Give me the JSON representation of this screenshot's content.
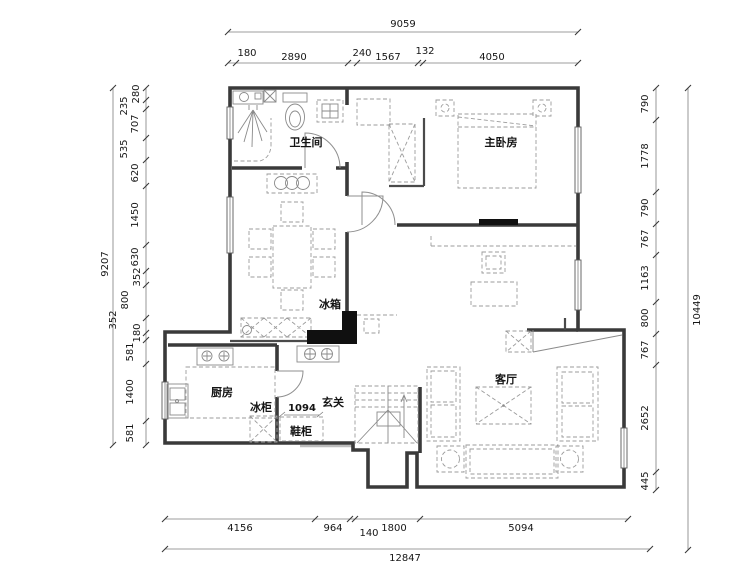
{
  "plan_type": "apartment-floor-plan",
  "rooms": {
    "bathroom": "卫生间",
    "master_bedroom": "主卧房",
    "kitchen": "厨房",
    "living_room": "客厅",
    "entrance": "玄关",
    "fridge": "冰箱",
    "freezer": "冰柜",
    "shoe_cabinet": "鞋柜"
  },
  "annotations": {
    "entry_width": "1094"
  },
  "dims": {
    "top_total": "9059",
    "top": [
      "180",
      "2890",
      "240",
      "1567",
      "132",
      "4050"
    ],
    "bottom_total": "12847",
    "bottom": [
      "4156",
      "964",
      "140",
      "1800",
      "5094"
    ],
    "left_total": "9207",
    "left": [
      "280",
      "235",
      "707",
      "535",
      "620",
      "1450",
      "630",
      "352",
      "800",
      "352",
      "180",
      "581",
      "1400",
      "581"
    ],
    "right_total": "10449",
    "right": [
      "790",
      "1778",
      "790",
      "767",
      "1163",
      "800",
      "767",
      "2652",
      "445"
    ]
  },
  "colors": {
    "wall": "#3a3a3a",
    "dimension_line": "#7d7d7d",
    "text": "#161616",
    "furniture": "#9b9b9b",
    "solid_fill": "#101010",
    "background": "#ffffff"
  }
}
